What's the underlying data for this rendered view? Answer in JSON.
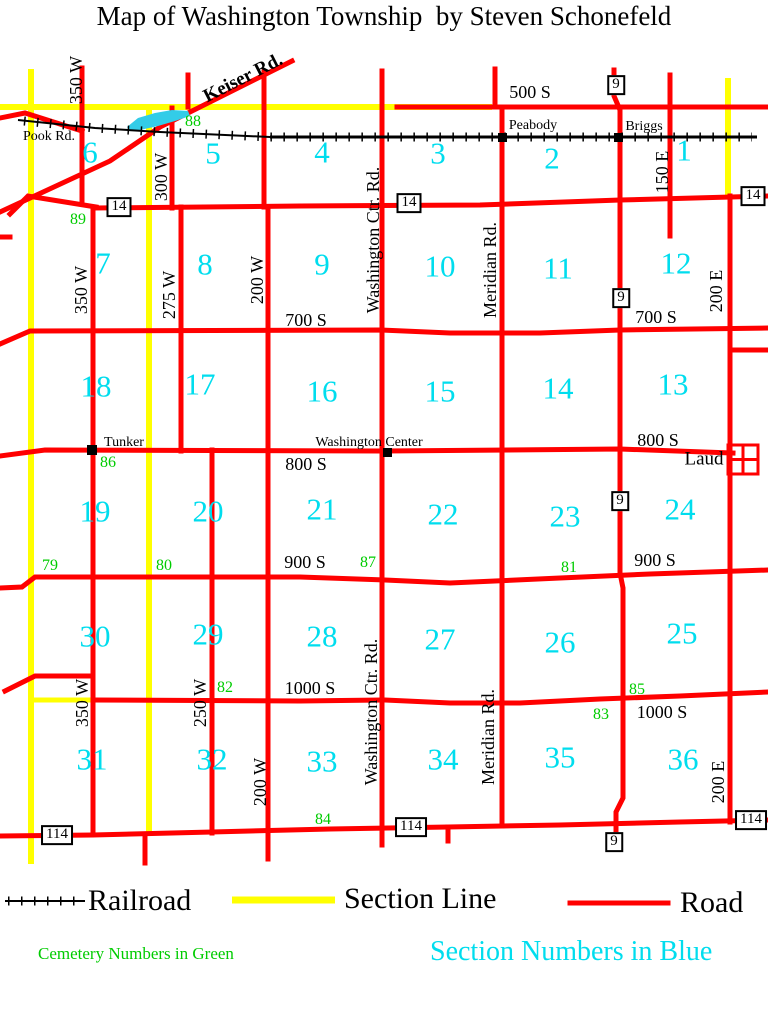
{
  "title": "Map of Washington Township  by Steven Schonefeld",
  "colors": {
    "road": "#FF0000",
    "section_line": "#FFFF00",
    "railroad": "#000000",
    "section_number": "#00DDEE",
    "cemetery_number": "#00CC00",
    "lake": "#33CCE8"
  },
  "legend": {
    "railroad_label": "Railroad",
    "section_line_label": "Section Line",
    "road_label": "Road",
    "cemetery_note": "Cemetery Numbers in Green",
    "section_note": "Section Numbers in Blue"
  },
  "sections": [
    {
      "t": "6",
      "x": 90,
      "y": 152
    },
    {
      "t": "5",
      "x": 213,
      "y": 153
    },
    {
      "t": "4",
      "x": 322,
      "y": 152
    },
    {
      "t": "3",
      "x": 438,
      "y": 153
    },
    {
      "t": "2",
      "x": 552,
      "y": 158
    },
    {
      "t": "1",
      "x": 684,
      "y": 150
    },
    {
      "t": "7",
      "x": 103,
      "y": 263
    },
    {
      "t": "8",
      "x": 205,
      "y": 264
    },
    {
      "t": "9",
      "x": 322,
      "y": 264
    },
    {
      "t": "10",
      "x": 440,
      "y": 266
    },
    {
      "t": "11",
      "x": 558,
      "y": 268
    },
    {
      "t": "12",
      "x": 676,
      "y": 263
    },
    {
      "t": "18",
      "x": 96,
      "y": 386
    },
    {
      "t": "17",
      "x": 200,
      "y": 384
    },
    {
      "t": "16",
      "x": 322,
      "y": 391
    },
    {
      "t": "15",
      "x": 440,
      "y": 391
    },
    {
      "t": "14",
      "x": 558,
      "y": 388
    },
    {
      "t": "13",
      "x": 673,
      "y": 384
    },
    {
      "t": "19",
      "x": 95,
      "y": 511
    },
    {
      "t": "20",
      "x": 208,
      "y": 511
    },
    {
      "t": "21",
      "x": 322,
      "y": 509
    },
    {
      "t": "22",
      "x": 443,
      "y": 514
    },
    {
      "t": "23",
      "x": 565,
      "y": 516
    },
    {
      "t": "24",
      "x": 680,
      "y": 509
    },
    {
      "t": "30",
      "x": 95,
      "y": 636
    },
    {
      "t": "29",
      "x": 208,
      "y": 634
    },
    {
      "t": "28",
      "x": 322,
      "y": 636
    },
    {
      "t": "27",
      "x": 440,
      "y": 639
    },
    {
      "t": "26",
      "x": 560,
      "y": 642
    },
    {
      "t": "25",
      "x": 682,
      "y": 633
    },
    {
      "t": "31",
      "x": 92,
      "y": 759
    },
    {
      "t": "32",
      "x": 212,
      "y": 759
    },
    {
      "t": "33",
      "x": 322,
      "y": 761
    },
    {
      "t": "34",
      "x": 443,
      "y": 759
    },
    {
      "t": "35",
      "x": 560,
      "y": 757
    },
    {
      "t": "36",
      "x": 683,
      "y": 759
    }
  ],
  "cemeteries": [
    {
      "t": "88",
      "x": 193,
      "y": 122
    },
    {
      "t": "89",
      "x": 78,
      "y": 220
    },
    {
      "t": "86",
      "x": 108,
      "y": 463
    },
    {
      "t": "79",
      "x": 50,
      "y": 566
    },
    {
      "t": "80",
      "x": 164,
      "y": 566
    },
    {
      "t": "87",
      "x": 368,
      "y": 563
    },
    {
      "t": "81",
      "x": 569,
      "y": 568
    },
    {
      "t": "82",
      "x": 225,
      "y": 688
    },
    {
      "t": "85",
      "x": 637,
      "y": 690
    },
    {
      "t": "83",
      "x": 601,
      "y": 715
    },
    {
      "t": "84",
      "x": 323,
      "y": 820
    }
  ],
  "labels": [
    {
      "t": "500 S",
      "x": 530,
      "y": 92,
      "cls": "roadlbl",
      "nm": "road-label-500s"
    },
    {
      "t": "700 S",
      "x": 306,
      "y": 320,
      "cls": "roadlbl",
      "nm": "road-label-700s-west"
    },
    {
      "t": "700 S",
      "x": 656,
      "y": 317,
      "cls": "roadlbl",
      "nm": "road-label-700s-east"
    },
    {
      "t": "800 S",
      "x": 306,
      "y": 464,
      "cls": "roadlbl",
      "nm": "road-label-800s-west"
    },
    {
      "t": "800 S",
      "x": 658,
      "y": 440,
      "cls": "roadlbl",
      "nm": "road-label-800s-east"
    },
    {
      "t": "900 S",
      "x": 305,
      "y": 562,
      "cls": "roadlbl",
      "nm": "road-label-900s-west"
    },
    {
      "t": "900 S",
      "x": 655,
      "y": 560,
      "cls": "roadlbl",
      "nm": "road-label-900s-east"
    },
    {
      "t": "1000 S",
      "x": 310,
      "y": 688,
      "cls": "roadlbl",
      "nm": "road-label-1000s-west"
    },
    {
      "t": "1000 S",
      "x": 662,
      "y": 712,
      "cls": "roadlbl",
      "nm": "road-label-1000s-east"
    },
    {
      "t": "350 W",
      "x": 76,
      "y": 80,
      "rot": -90,
      "cls": "roadlbl",
      "nm": "road-label-350w-north"
    },
    {
      "t": "350 W",
      "x": 81,
      "y": 290,
      "rot": -90,
      "cls": "roadlbl",
      "nm": "road-label-350w-mid"
    },
    {
      "t": "350 W",
      "x": 82,
      "y": 703,
      "rot": -90,
      "cls": "roadlbl",
      "nm": "road-label-350w-south"
    },
    {
      "t": "300 W",
      "x": 161,
      "y": 177,
      "rot": -90,
      "cls": "roadlbl",
      "nm": "road-label-300w"
    },
    {
      "t": "275 W",
      "x": 169,
      "y": 295,
      "rot": -90,
      "cls": "roadlbl",
      "nm": "road-label-275w"
    },
    {
      "t": "200 W",
      "x": 257,
      "y": 280,
      "rot": -90,
      "cls": "roadlbl",
      "nm": "road-label-200w-north"
    },
    {
      "t": "200 W",
      "x": 260,
      "y": 782,
      "rot": -90,
      "cls": "roadlbl",
      "nm": "road-label-200w-south"
    },
    {
      "t": "250 W",
      "x": 200,
      "y": 703,
      "rot": -90,
      "cls": "roadlbl",
      "nm": "road-label-250w"
    },
    {
      "t": "Washington Ctr. Rd.",
      "x": 373,
      "y": 240,
      "rot": -90,
      "cls": "roadlbl",
      "nm": "road-label-washington-ctr-north"
    },
    {
      "t": "Washington Ctr. Rd.",
      "x": 371,
      "y": 712,
      "rot": -90,
      "cls": "roadlbl",
      "nm": "road-label-washington-ctr-south"
    },
    {
      "t": "Meridian Rd.",
      "x": 490,
      "y": 270,
      "rot": -90,
      "cls": "roadlbl",
      "nm": "road-label-meridian-north"
    },
    {
      "t": "Meridian Rd.",
      "x": 488,
      "y": 737,
      "rot": -90,
      "cls": "roadlbl",
      "nm": "road-label-meridian-south"
    },
    {
      "t": "150 E",
      "x": 662,
      "y": 172,
      "rot": -90,
      "cls": "roadlbl",
      "nm": "road-label-150e"
    },
    {
      "t": "200 E",
      "x": 716,
      "y": 291,
      "rot": -90,
      "cls": "roadlbl",
      "nm": "road-label-200e-north"
    },
    {
      "t": "200 E",
      "x": 718,
      "y": 782,
      "rot": -90,
      "cls": "roadlbl",
      "nm": "road-label-200e-south"
    },
    {
      "t": "Keiser Rd.",
      "x": 243,
      "y": 78,
      "rot": -27,
      "cls": "keiser",
      "nm": "road-label-keiser"
    },
    {
      "t": "Pook Rd.",
      "x": 49,
      "y": 137,
      "cls": "town",
      "nm": "road-label-pook"
    },
    {
      "t": "Peabody",
      "x": 533,
      "y": 126,
      "cls": "town",
      "nm": "town-label-peabody"
    },
    {
      "t": "Briggs",
      "x": 644,
      "y": 127,
      "cls": "town",
      "nm": "town-label-briggs"
    },
    {
      "t": "Tunker",
      "x": 124,
      "y": 443,
      "cls": "town",
      "nm": "town-label-tunker"
    },
    {
      "t": "Washington Center",
      "x": 369,
      "y": 443,
      "cls": "town",
      "nm": "town-label-washington-center"
    },
    {
      "t": "Laud",
      "x": 704,
      "y": 459,
      "cls": "laud",
      "nm": "town-label-laud"
    }
  ],
  "markers": [
    {
      "t": "14",
      "x": 119,
      "y": 207
    },
    {
      "t": "14",
      "x": 409,
      "y": 203
    },
    {
      "t": "14",
      "x": 753,
      "y": 196
    },
    {
      "t": "9",
      "x": 616,
      "y": 85
    },
    {
      "t": "9",
      "x": 621,
      "y": 298
    },
    {
      "t": "9",
      "x": 620,
      "y": 501
    },
    {
      "t": "9",
      "x": 614,
      "y": 842
    },
    {
      "t": "114",
      "x": 57,
      "y": 835
    },
    {
      "t": "114",
      "x": 411,
      "y": 827
    },
    {
      "t": "114",
      "x": 751,
      "y": 820
    }
  ]
}
